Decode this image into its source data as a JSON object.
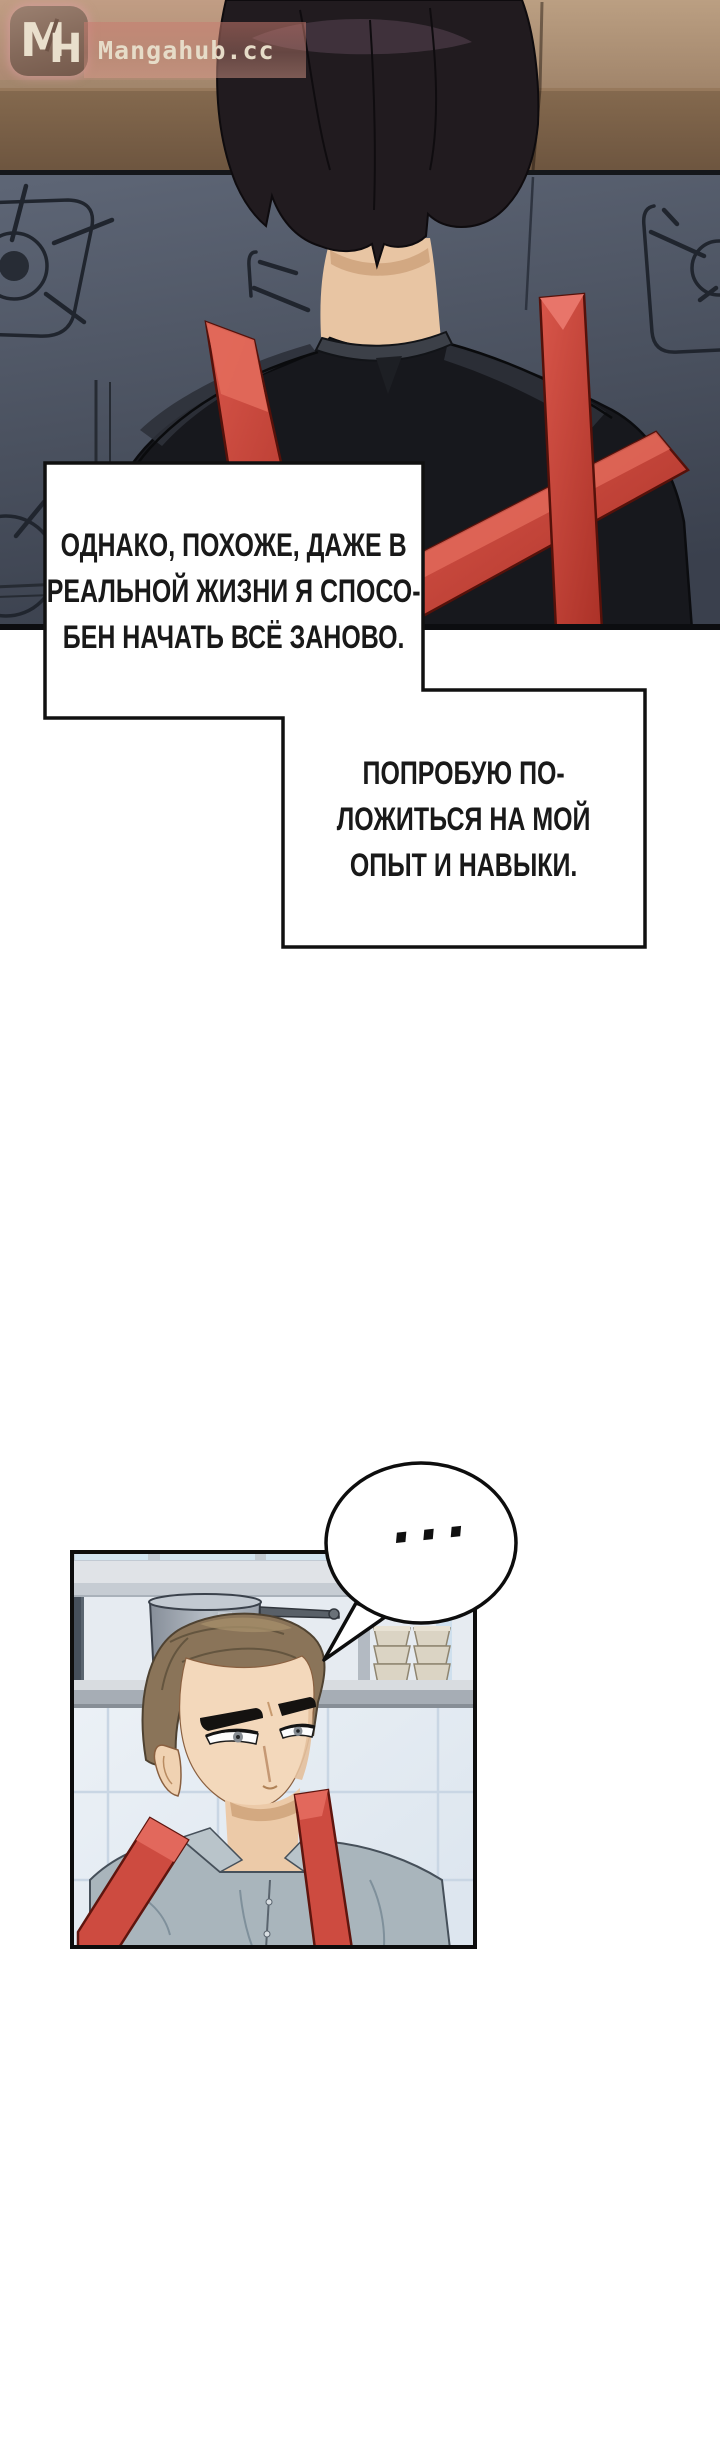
{
  "watermark": {
    "site_name": "Mangahub.cc",
    "monogram_m": "M",
    "monogram_h": "H",
    "badge_color": "#8d7262",
    "text_color": "#e6dcc8"
  },
  "bubbles": [
    {
      "text": "ОДНАКО, ПОХОЖЕ, ДАЖЕ В\nРЕАЛЬНОЙ ЖИЗНИ Я СПОСО-\nБЕН НАЧАТЬ ВСЁ ЗАНОВО."
    },
    {
      "text": "ПОПРОБУЮ ПО-\nЛОЖИТЬСЯ НА МОЙ\nОПЫТ И НАВЫКИ."
    }
  ],
  "ellipsis_bubble": {
    "text": "..."
  },
  "scene_colors": {
    "counter_tan": "#b29878",
    "counter_brown": "#7a6148",
    "stove_gray": "#4e5665",
    "jacket_black": "#17181c",
    "suspender_red": "#c9443a",
    "hair_dark": "#211b1f",
    "skin": "#e8c5a3",
    "panel_tile": "#eef2f7",
    "panel_hair_brown": "#8a7459",
    "panel_shirt_gray": "#a9b5bc",
    "page_background": "#ffffff"
  }
}
